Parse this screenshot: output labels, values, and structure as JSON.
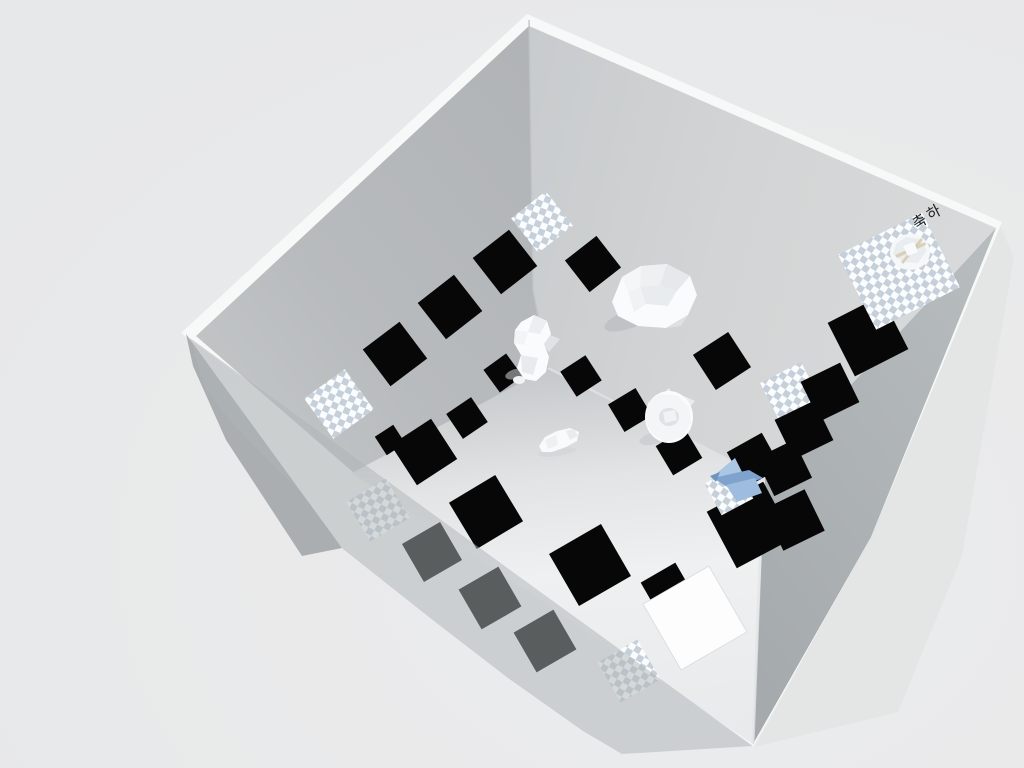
{
  "scene": {
    "width": 1024,
    "height": 768,
    "background": "#e9eaea",
    "wall_text": {
      "value": "축하",
      "color": "#1e1e1e",
      "size": 15
    },
    "colors": {
      "tile_black": "#070707",
      "tile_white": "#fdfdfd",
      "checker_cell": "#c6d0da",
      "checker_bg": "#fbfcfd",
      "blue_object": "#7fa3cc",
      "wall_left": "#b3b6b8",
      "wall_right": "#d2d4d5",
      "front_band": "#abb0b3",
      "floor_bright": "#eff0f1",
      "rim": "#f7f8f8"
    },
    "layers": [
      {
        "kind": "polygons",
        "items": [
          {
            "name": "front-right-wall-outer",
            "points": "999,222 1014,258 962,556 898,712 755,747 869,538",
            "fill": "#e4e6e6"
          },
          {
            "name": "box-rim",
            "points": "527,14 1002,222 871,537 753,747 181,333",
            "fill": "#f7f8f8"
          },
          {
            "name": "left-wall-outer-edge",
            "points": "186,334 342,548 302,556 226,440 193,366",
            "fill": "#aaaeb1"
          },
          {
            "name": "wall-back-left",
            "points": "529,26 196,336 354,473 548,368 533,290",
            "fill": "url(#gWL)"
          },
          {
            "name": "wall-back-right",
            "points": "529,26 533,290 548,368 765,478 996,228",
            "fill": "url(#gWR)"
          },
          {
            "name": "wall-front-right-band",
            "points": "996,228 765,478 753,744 871,537",
            "fill": "url(#gBand)"
          },
          {
            "name": "floor",
            "points": "548,368 765,478 753,744 352,473",
            "fill": "url(#gFloor)"
          }
        ]
      },
      {
        "kind": "lines",
        "items": [
          {
            "name": "back-corner-edge",
            "points": "529,20 533,290 548,368",
            "stroke": "#c0c3c5",
            "w": 1.5,
            "opacity": 0.9
          },
          {
            "name": "floor-ne-edge-highlight",
            "points": "548,368 765,478",
            "stroke": "#dfe2e3",
            "w": 2.5,
            "opacity": 0.8
          },
          {
            "name": "floor-se-edge-highlight",
            "points": "763,484 753,744",
            "stroke": "#e2e5e6",
            "w": 3,
            "opacity": 0.8
          }
        ]
      },
      {
        "kind": "tiles",
        "items": [
          {
            "name": "tile-checker-corner",
            "cx": 542,
            "cy": 222,
            "s": 44,
            "rot": -38,
            "type": "checker"
          },
          {
            "name": "tile-black-1",
            "cx": 505,
            "cy": 262,
            "s": 46,
            "rot": -38,
            "type": "black"
          },
          {
            "name": "tile-black-2",
            "cx": 450,
            "cy": 307,
            "s": 46,
            "rot": -38,
            "type": "black"
          },
          {
            "name": "tile-black-3",
            "cx": 395,
            "cy": 354,
            "s": 46,
            "rot": -37,
            "type": "black"
          },
          {
            "name": "tile-checker-left-wall",
            "cx": 339,
            "cy": 404,
            "s": 50,
            "rot": -36,
            "type": "checker"
          },
          {
            "name": "tile-black-4",
            "cx": 503,
            "cy": 373,
            "s": 28,
            "rot": -36,
            "type": "black"
          },
          {
            "name": "tile-black-5",
            "cx": 467,
            "cy": 418,
            "s": 30,
            "rot": -34,
            "type": "black"
          },
          {
            "name": "tile-black-6",
            "cx": 424,
            "cy": 452,
            "s": 48,
            "rot": -33,
            "type": "black"
          },
          {
            "name": "tile-black-6b",
            "cx": 390,
            "cy": 440,
            "s": 22,
            "rot": -33,
            "type": "black"
          },
          {
            "name": "tile-black-7",
            "cx": 486,
            "cy": 512,
            "s": 54,
            "rot": -31,
            "type": "black"
          },
          {
            "name": "tile-black-8",
            "cx": 590,
            "cy": 565,
            "s": 60,
            "rot": -30,
            "type": "black"
          },
          {
            "name": "tile-black-9",
            "cx": 593,
            "cy": 264,
            "s": 40,
            "rot": -38,
            "type": "black"
          },
          {
            "name": "tile-black-10",
            "cx": 581,
            "cy": 376,
            "s": 30,
            "rot": -33,
            "type": "black"
          },
          {
            "name": "tile-black-11",
            "cx": 630,
            "cy": 410,
            "s": 32,
            "rot": -31,
            "type": "black"
          },
          {
            "name": "tile-black-12",
            "cx": 722,
            "cy": 361,
            "s": 42,
            "rot": -33,
            "type": "black"
          },
          {
            "name": "tile-black-13",
            "cx": 679,
            "cy": 452,
            "s": 34,
            "rot": -31,
            "type": "black"
          },
          {
            "name": "tile-black-14",
            "cx": 754,
            "cy": 460,
            "s": 40,
            "rot": -29,
            "type": "black"
          },
          {
            "name": "tile-black-15",
            "cx": 868,
            "cy": 336,
            "s": 60,
            "rot": -27,
            "type": "black"
          },
          {
            "name": "tile-checker-right-wall",
            "cx": 791,
            "cy": 393,
            "s": 46,
            "rot": -27,
            "type": "checker"
          },
          {
            "name": "tile-checker-big",
            "cx": 899,
            "cy": 271,
            "w": 94,
            "h": 84,
            "rot": -27,
            "type": "checker"
          },
          {
            "name": "tile-black-16",
            "cx": 830,
            "cy": 392,
            "s": 44,
            "rot": -26,
            "type": "black"
          },
          {
            "name": "tile-black-17",
            "cx": 804,
            "cy": 430,
            "s": 44,
            "rot": -26,
            "type": "black"
          },
          {
            "name": "tile-black-18",
            "cx": 784,
            "cy": 468,
            "s": 42,
            "rot": -26,
            "type": "black"
          },
          {
            "name": "tile-black-19",
            "cx": 794,
            "cy": 520,
            "s": 46,
            "rot": -26,
            "type": "black"
          },
          {
            "name": "tile-black-20",
            "cx": 750,
            "cy": 525,
            "s": 64,
            "rot": -28,
            "type": "black"
          },
          {
            "name": "tile-checker-floor",
            "cx": 729,
            "cy": 491,
            "s": 36,
            "rot": -28,
            "type": "checker"
          },
          {
            "name": "tile-black-21",
            "cx": 668,
            "cy": 590,
            "s": 40,
            "rot": -30,
            "type": "black"
          },
          {
            "name": "tile-white-goal",
            "cx": 695,
            "cy": 618,
            "s": 76,
            "rot": -30,
            "type": "white"
          },
          {
            "name": "tile-checker-dim-left",
            "cx": 378,
            "cy": 510,
            "s": 46,
            "rot": -31,
            "type": "checker"
          },
          {
            "name": "tile-black-dim-1",
            "cx": 432,
            "cy": 552,
            "s": 44,
            "rot": -30,
            "type": "black"
          },
          {
            "name": "tile-black-dim-2",
            "cx": 490,
            "cy": 598,
            "s": 46,
            "rot": -30,
            "type": "black"
          },
          {
            "name": "tile-black-dim-3",
            "cx": 545,
            "cy": 641,
            "s": 46,
            "rot": -30,
            "type": "black"
          },
          {
            "name": "tile-checker-dim-bottom",
            "cx": 629,
            "cy": 671,
            "s": 46,
            "rot": -30,
            "type": "checker"
          }
        ]
      },
      {
        "kind": "figures",
        "items": [
          {
            "name": "creature-cat-shadow",
            "parts": [
              {
                "e": [
                  630,
                  319,
                  27,
                  9
                ],
                "fill": "#b5b9bc",
                "rot": -20,
                "opacity": 0.6
              }
            ]
          },
          {
            "name": "creature-cat",
            "parts": [
              {
                "pts": "612,302 622,277 641,266 667,264 690,276 697,295 688,315 666,328 638,326 618,316",
                "fill": "#fafbfc"
              },
              {
                "pts": "641,266 667,264 660,285 640,287",
                "fill": "#eef0f2"
              },
              {
                "pts": "667,264 690,276 676,292 660,285",
                "fill": "#e6e9ec"
              },
              {
                "pts": "622,277 641,266 640,287 628,292",
                "fill": "#f4f6f7"
              },
              {
                "pts": "640,287 660,285 676,292 668,306 646,304",
                "fill": "#e9ecee"
              },
              {
                "pts": "628,292 640,287 646,304 634,312",
                "fill": "#f0f2f4"
              },
              {
                "pts": "666,328 688,315 681,326",
                "fill": "#dde1e4"
              }
            ]
          },
          {
            "name": "creature-squirrel-shadow",
            "parts": [
              {
                "e": [
                  516,
                  374,
                  11,
                  5
                ],
                "fill": "#bfc3c6",
                "rot": -15,
                "opacity": 0.6
              }
            ]
          },
          {
            "name": "creature-squirrel",
            "parts": [
              {
                "pts": "545,333 560,339 549,352 542,344",
                "fill": "#dfe3e7"
              },
              {
                "pts": "521,322 534,315 547,321 551,334 544,344 549,357 546,372 536,381 524,379 517,368 521,355 514,343 515,330",
                "fill": "#fafbfc"
              },
              {
                "pts": "534,315 547,321 540,334 528,332",
                "fill": "#eceff1"
              },
              {
                "pts": "521,355 538,358 533,375 522,372",
                "fill": "#e8ebee"
              },
              {
                "pts": "515,330 528,332 524,345 514,343",
                "fill": "#f2f4f5"
              },
              {
                "e": [
                  519,
                  380,
                  6,
                  4
                ],
                "fill": "#f1f3f4"
              }
            ]
          },
          {
            "name": "creature-donut-shadow",
            "parts": [
              {
                "e": [
                  655,
                  438,
                  16,
                  6
                ],
                "fill": "#c2c6c9",
                "rot": -15,
                "opacity": 0.55
              }
            ]
          },
          {
            "name": "creature-donut",
            "parts": [
              {
                "pts": "661,396 669,388 674,399",
                "fill": "#eef1f3"
              },
              {
                "pts": "684,396 695,401 687,410",
                "fill": "#e9edf0"
              },
              {
                "e": [
                  669,
                  417,
                  24,
                  26
                ],
                "fill": "#fafbfc"
              },
              {
                "pts": "648,403 660,394 678,396 689,407 691,423 682,437 666,442 652,434 645,420",
                "fill": "#f3f5f6"
              },
              {
                "e": [
                  669,
                  417,
                  10,
                  9
                ],
                "fill": "#dde2e5"
              },
              {
                "pts": "663,412 675,410 677,420 665,423",
                "fill": "#f0f2f4"
              }
            ]
          },
          {
            "name": "creature-bird-shadow",
            "parts": [
              {
                "e": [
                  557,
                  452,
                  19,
                  4
                ],
                "fill": "#d2d5d7",
                "rot": -8,
                "opacity": 0.7
              }
            ]
          },
          {
            "name": "creature-bird",
            "parts": [
              {
                "pts": "539,446 545,437 557,431 570,428 579,432 577,441 566,447 552,452 542,452",
                "fill": "#f8fafb"
              },
              {
                "pts": "566,431 574,429 578,436 570,440",
                "fill": "#e9eced"
              },
              {
                "pts": "545,440 556,435 558,445 548,449",
                "fill": "#eef1f2"
              }
            ]
          },
          {
            "name": "crumpled-ball",
            "parts": [
              {
                "e": [
                  910,
                  252,
                  20,
                  18
                ],
                "fill": "#f5f7f8"
              },
              {
                "pts": "896,244 906,237 920,239 927,250 918,263 903,262 893,254",
                "fill": "#eaedef"
              },
              {
                "pts": "895,255 925,242 926,245 897,258",
                "fill": "#d4c8ac",
                "opacity": 0.8
              },
              {
                "pts": "901,262 921,238 923,240 903,264",
                "fill": "#cfc2a6",
                "opacity": 0.7
              },
              {
                "pts": "903,246 914,242 918,252 908,256",
                "fill": "#f9fafb"
              }
            ]
          },
          {
            "name": "blue-plane",
            "parts": [
              {
                "pts": "712,477 735,458 743,474 726,485",
                "fill": "#aac6e4"
              },
              {
                "pts": "713,478 749,470 763,478 732,490",
                "fill": "#7fa3cc"
              },
              {
                "pts": "726,485 755,478 762,493 737,502",
                "fill": "#9dbcde"
              },
              {
                "pts": "710,476 720,472 716,482",
                "fill": "#6f94bf"
              }
            ]
          }
        ]
      },
      {
        "kind": "polygons",
        "items": [
          {
            "name": "wall-front-left-overlay",
            "points": "190,338 753,746 622,754 583,731 508,678 434,621 343,549 299,491 232,423 204,387",
            "fill": "rgba(174,179,182,0.5)"
          }
        ]
      }
    ]
  }
}
